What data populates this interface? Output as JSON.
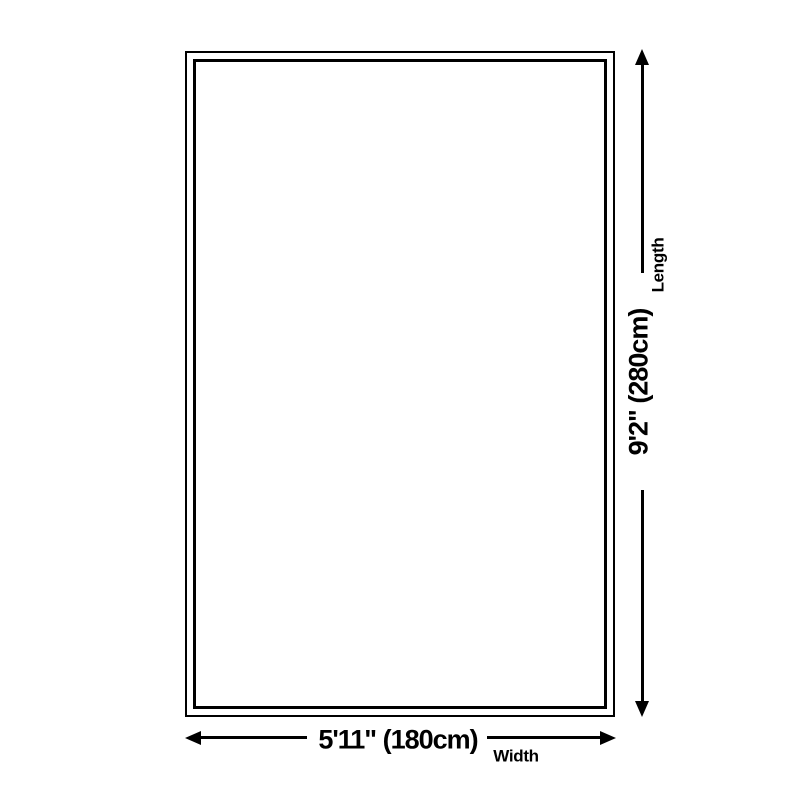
{
  "diagram": {
    "background_color": "#ffffff",
    "line_color": "#000000",
    "length_dimension": {
      "value": "9'2\" (280cm)",
      "label": "Length"
    },
    "width_dimension": {
      "value": "5'11\" (180cm)",
      "label": "Width"
    }
  }
}
